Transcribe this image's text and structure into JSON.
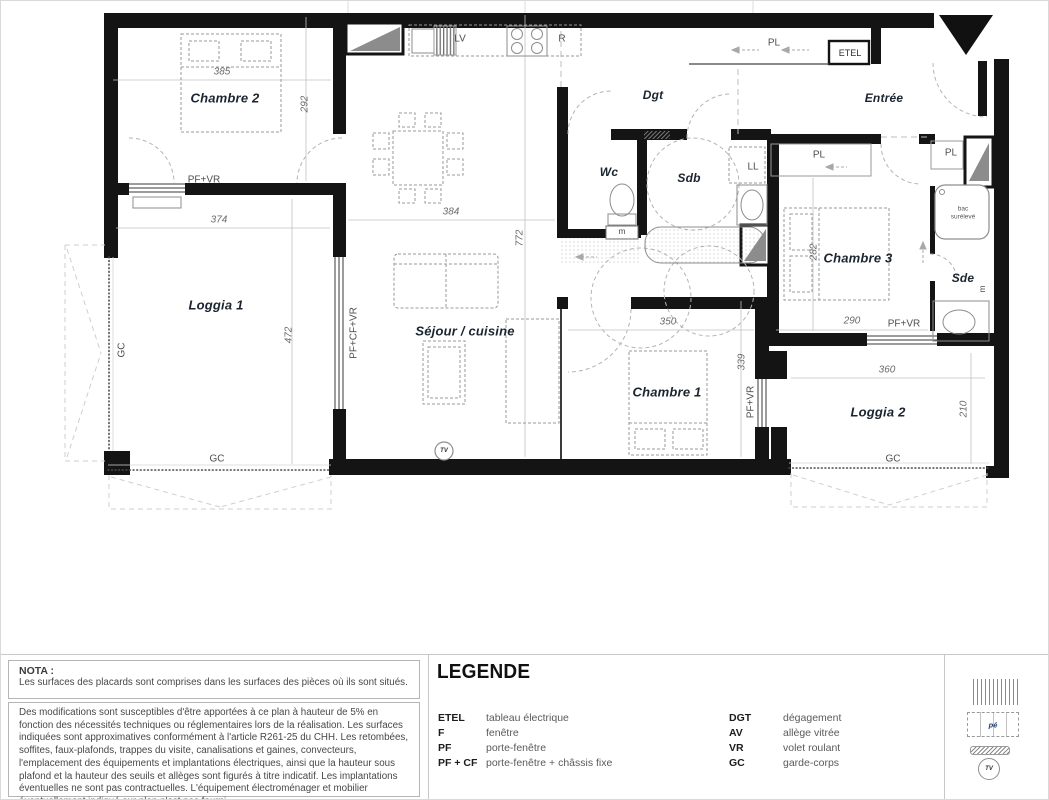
{
  "plan": {
    "rooms": {
      "chambre2": "Chambre 2",
      "loggia1": "Loggia 1",
      "sejour": "Séjour / cuisine",
      "wc": "Wc",
      "sdb": "Sdb",
      "dgt": "Dgt",
      "entree": "Entrée",
      "chambre3": "Chambre 3",
      "sde": "Sde",
      "chambre1": "Chambre 1",
      "loggia2": "Loggia 2"
    },
    "dims": {
      "chambre2_w": "385",
      "chambre2_h": "292",
      "loggia1_w": "374",
      "loggia1_h": "472",
      "sejour_w": "384",
      "sejour_h": "772",
      "chambre1_w": "350",
      "chambre1_h": "339",
      "chambre3_h": "282",
      "chambre3_w": "290",
      "loggia2_w": "360",
      "loggia2_h": "210"
    },
    "tags": {
      "pf_vr": "PF+VR",
      "pf_cf_vr": "PF+CF+VR",
      "gc": "GC",
      "pl": "PL",
      "etel": "ETEL",
      "ll": "LL",
      "lv": "LV",
      "r": "R",
      "m": "m",
      "bac1": "bac",
      "bac2": "surélevé",
      "tv": "TV",
      "pe": "pé"
    }
  },
  "legend": {
    "title": "LEGENDE",
    "left": [
      {
        "abbr": "ETEL",
        "desc": "tableau électrique"
      },
      {
        "abbr": "F",
        "desc": "fenêtre"
      },
      {
        "abbr": "PF",
        "desc": "porte-fenêtre"
      },
      {
        "abbr": "PF + CF",
        "desc": "porte-fenêtre + châssis fixe"
      }
    ],
    "right": [
      {
        "abbr": "DGT",
        "desc": "dégagement"
      },
      {
        "abbr": "AV",
        "desc": "allège vitrée"
      },
      {
        "abbr": "VR",
        "desc": "volet roulant"
      },
      {
        "abbr": "GC",
        "desc": "garde-corps"
      }
    ]
  },
  "nota": {
    "title": "NOTA :",
    "intro": "Les surfaces des placards sont comprises dans les surfaces des pièces où ils sont situés.",
    "body": "Des modifications sont susceptibles d'être apportées à ce plan à hauteur de 5% en fonction des nécessités techniques ou réglementaires lors de la réalisation. Les surfaces indiquées sont approximatives conformément à l'article R261-25 du CHH. Les retombées, soffites, faux-plafonds, trappes du visite, canalisations et gaines, convecteurs, l'emplacement des équipements et implantations électriques, ainsi que la hauteur sous plafond et la hauteur des seuils et allèges sont figurés à titre indicatif. Les implantations éventuelles ne sont pas contractuelles. L'équipement électroménager et mobilier éventuellement indiqué sur plan n'est pas fourni."
  },
  "colors": {
    "wall": "#141414",
    "room_label": "#1b2530",
    "dim": "#6b6b6b",
    "annotation": "#4e4e4e"
  }
}
